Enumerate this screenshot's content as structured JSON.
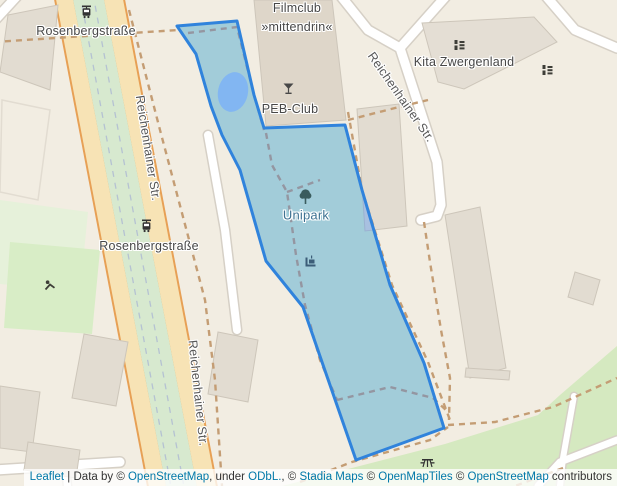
{
  "labels": {
    "rosenbergstrasse_top": "Rosenbergstraße",
    "rosenbergstrasse_mid": "Rosenbergstraße",
    "filmclub_line1": "Filmclub",
    "filmclub_line2": "»mittendrin«",
    "peb_club": "PEB-Club",
    "kita_zwergenland": "Kita Zwergenland",
    "unipark": "Unipark",
    "reichenhainer_str_west": "Reichenhainer Str.",
    "reichenhainer_str_east": "Reichenhainer Str.",
    "reichenhainer_str_south": "Reichenhainer Str."
  },
  "icons": {
    "tram_stop_top": "tram-stop-icon",
    "tram_stop_mid": "tram-stop-icon",
    "bar": "cocktail-bar-icon",
    "kindergarten_1": "kindergarten-icon",
    "kindergarten_2": "kindergarten-icon",
    "park_tree": "tree-icon",
    "memorial": "memorial-icon",
    "playground": "playground-icon",
    "picnic": "picnic-table-icon"
  },
  "colors": {
    "selection_stroke": "#3083dc",
    "selection_fill": "#3388ff",
    "link_blue": "#0078a8",
    "park_green": "#d8edc6",
    "road_casing_orange": "#e7a055",
    "road_fill_tan": "#f7e3b5",
    "background_cream": "#f2ede2"
  },
  "attribution": {
    "segments": [
      {
        "text": "Leaflet",
        "link": true
      },
      {
        "text": " | Data by © ",
        "link": false
      },
      {
        "text": "OpenStreetMap",
        "link": true
      },
      {
        "text": ", under ",
        "link": false
      },
      {
        "text": "ODbL.",
        "link": true
      },
      {
        "text": ", © ",
        "link": false
      },
      {
        "text": "Stadia Maps",
        "link": true
      },
      {
        "text": " © ",
        "link": false
      },
      {
        "text": "OpenMapTiles",
        "link": true
      },
      {
        "text": " © ",
        "link": false
      },
      {
        "text": "OpenStreetMap",
        "link": true
      },
      {
        "text": " contributors",
        "link": false
      }
    ]
  }
}
